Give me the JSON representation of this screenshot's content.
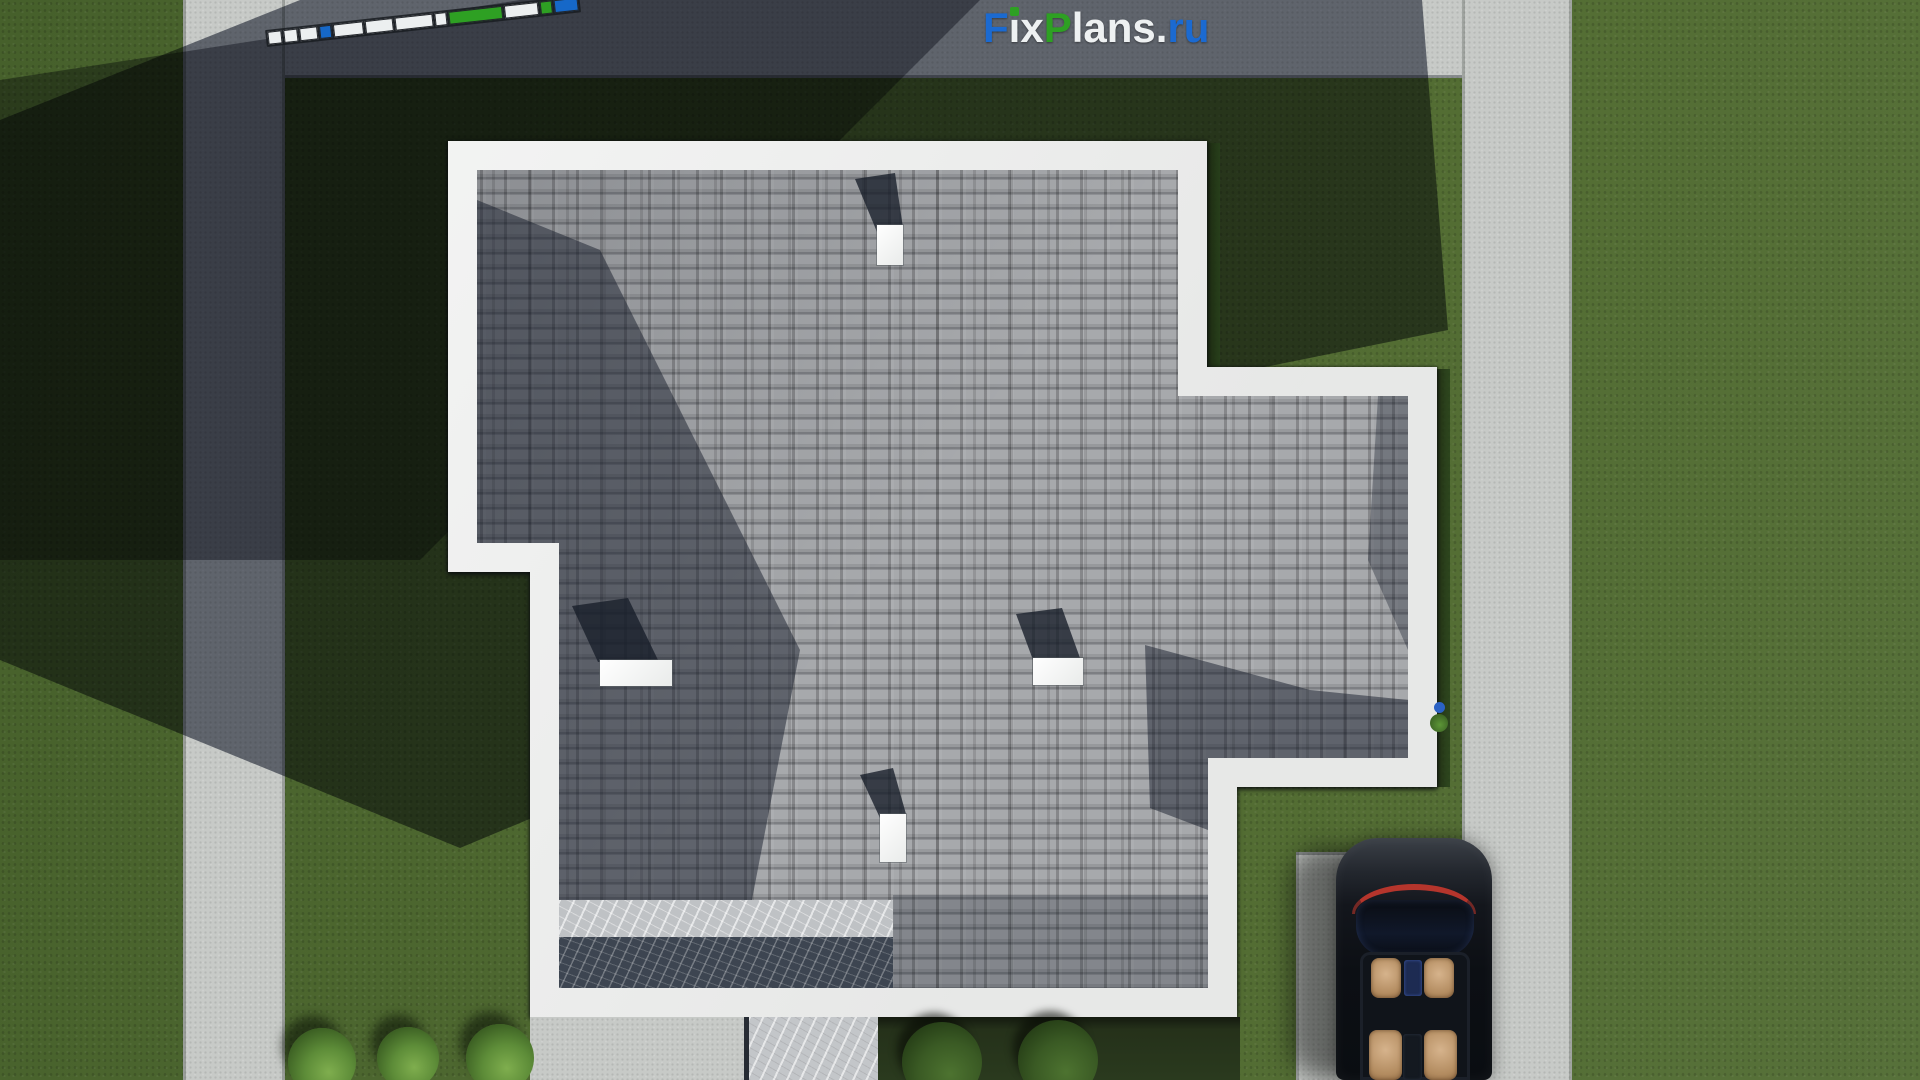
{
  "site": {
    "watermark_text": "FixPlans.ru"
  },
  "logo": {
    "parts": [
      {
        "text": "F",
        "color": "#1b6ad1"
      },
      {
        "text": "i",
        "render": "ı",
        "color": "#eef1f2",
        "dot": "#2ea023"
      },
      {
        "text": "x",
        "color": "#eef1f2"
      },
      {
        "text": "P",
        "color": "#2ea023"
      },
      {
        "text": "lans",
        "color": "#eef1f2"
      },
      {
        "text": ".",
        "color": "#eef1f2"
      },
      {
        "text": "ru",
        "color": "#1b6ad1"
      }
    ]
  },
  "scalebar": {
    "description": "tilted segmented drawing scale bar, no legible text",
    "segments": [
      {
        "w": 14,
        "color": "#eceff0"
      },
      {
        "w": 14,
        "color": "#eceff0"
      },
      {
        "w": 18,
        "color": "#eceff0"
      },
      {
        "w": 12,
        "color": "#1668c8"
      },
      {
        "w": 30,
        "color": "#eceff0"
      },
      {
        "w": 28,
        "color": "#eceff0"
      },
      {
        "w": 38,
        "color": "#eceff0"
      },
      {
        "w": 12,
        "color": "#eceff0"
      },
      {
        "w": 54,
        "color": "#2ea023"
      },
      {
        "w": 34,
        "color": "#eceff0"
      },
      {
        "w": 12,
        "color": "#2ea023"
      },
      {
        "w": 24,
        "color": "#1668c8"
      }
    ]
  },
  "scene": {
    "labels": {
      "house": "single-family house, top-down roof view",
      "roof": "gray asphalt-shingle roof with white fascia border",
      "terrace": "marble terrace strips at lower-left of roof",
      "car": "black convertible with tan seats on driveway",
      "roads": "concrete road left, concrete strip top, concrete path right, driveway bottom-right",
      "shadow": "long diagonal shadow cast across upper-left of the lot"
    },
    "chimneys": [
      {
        "x": 877,
        "y": 225,
        "w": 26,
        "h": 40,
        "sx": 847,
        "sy": 165,
        "sw": 66,
        "sh": 70,
        "clip": "polygon(30px 67px, 56px 63px, 48px 8px, 8px 14px)"
      },
      {
        "x": 600,
        "y": 660,
        "w": 72,
        "h": 26,
        "sx": 560,
        "sy": 596,
        "sw": 112,
        "sh": 70,
        "clip": "polygon(38px 66px, 98px 64px, 68px 2px, 12px 10px)"
      },
      {
        "x": 1033,
        "y": 658,
        "w": 50,
        "h": 27,
        "sx": 1000,
        "sy": 604,
        "sw": 96,
        "sh": 60,
        "clip": "polygon(33px 56px, 80px 54px, 62px 4px, 16px 10px)"
      },
      {
        "x": 880,
        "y": 814,
        "w": 26,
        "h": 48,
        "sx": 845,
        "sy": 760,
        "sw": 66,
        "sh": 60,
        "clip": "polygon(35px 58px, 61px 54px, 48px 8px, 15px 15px)"
      }
    ],
    "bushes": [
      {
        "x": 322,
        "y": 1062,
        "r": 34,
        "shade": "lit"
      },
      {
        "x": 408,
        "y": 1058,
        "r": 31,
        "shade": "lit"
      },
      {
        "x": 500,
        "y": 1058,
        "r": 34,
        "shade": "lit"
      },
      {
        "x": 942,
        "y": 1062,
        "r": 40,
        "shade": "dark"
      },
      {
        "x": 1058,
        "y": 1060,
        "r": 40,
        "shade": "dark"
      }
    ]
  },
  "colors": {
    "grass_lit": "#4e6830",
    "concrete": "#c7cac7",
    "roof_gray": "#9b9da0",
    "fascia_white": "#f3f4f3",
    "marble_dark": "#3d4551",
    "logo_blue": "#1b6ad1",
    "logo_green": "#2ea023",
    "taillight_red": "#b5352c",
    "car_black": "#0c0f14",
    "seat_tan": "#c8a27a"
  }
}
